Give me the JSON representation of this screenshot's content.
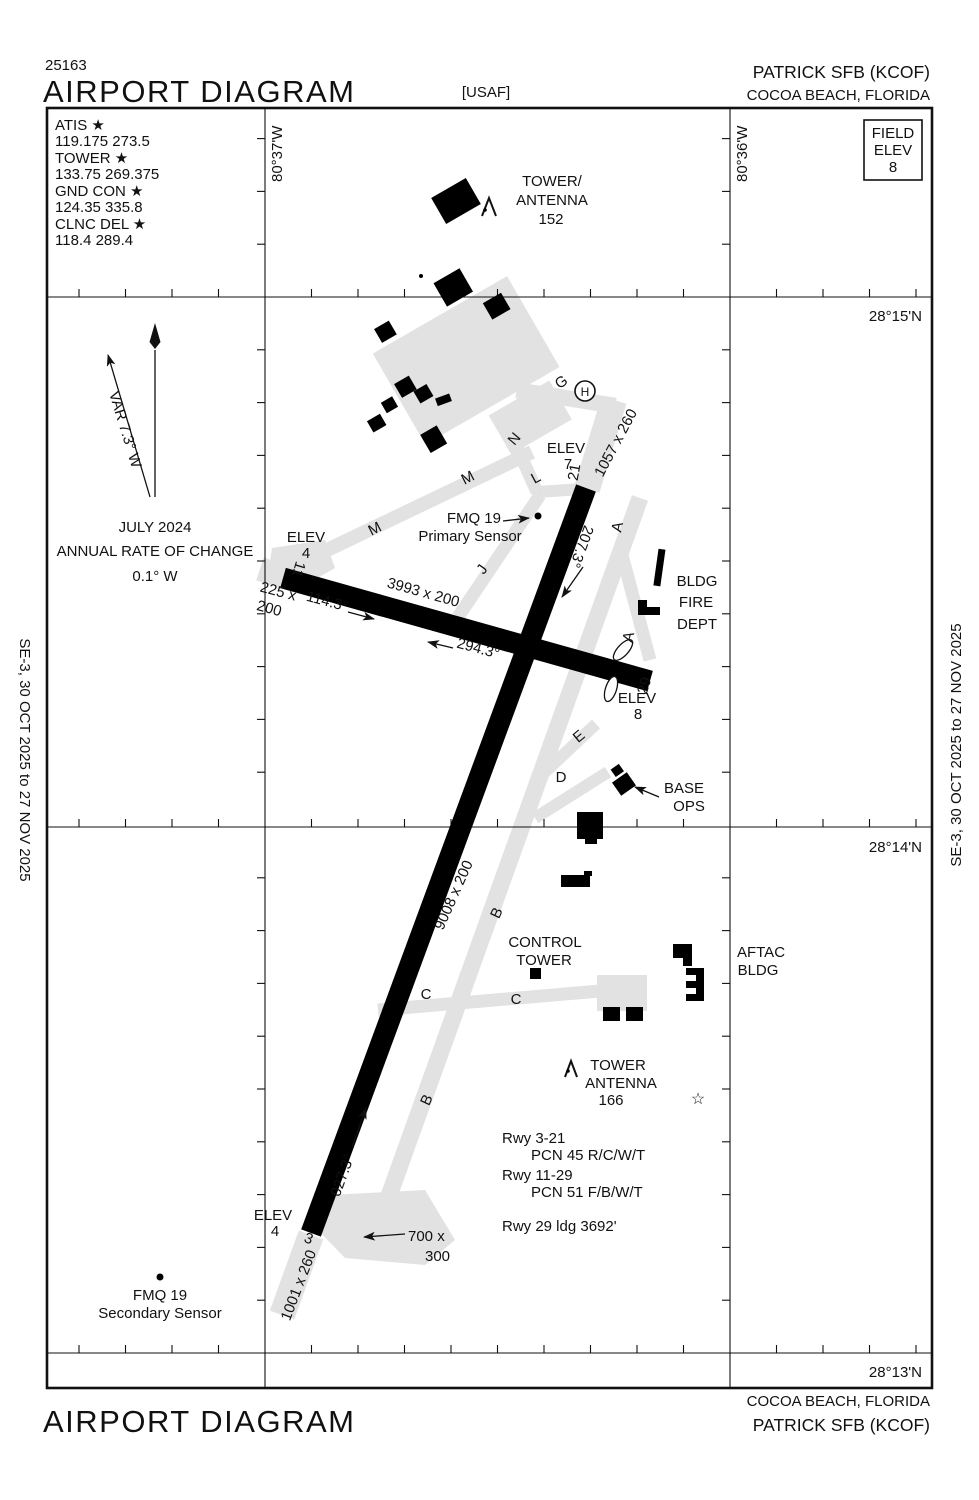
{
  "doc": {
    "chart_number": "25163",
    "title": "AIRPORT DIAGRAM",
    "title_bottom": "AIRPORT DIAGRAM",
    "operator": "[USAF]",
    "airport_top": "PATRICK SFB  (KCOF)",
    "city_top": "COCOA BEACH, FLORIDA",
    "airport_bottom": "PATRICK SFB  (KCOF)",
    "city_bottom": "COCOA BEACH, FLORIDA",
    "edition_left": "SE-3,  30 OCT 2025  to  27 NOV 2025",
    "edition_right": "SE-3,  30 OCT 2025  to  27 NOV 2025"
  },
  "comms": {
    "lines": [
      "ATIS ★",
      "119.175  273.5",
      "TOWER ★",
      "133.75  269.375",
      "GND CON ★",
      "124.35  335.8",
      "CLNC DEL ★",
      "118.4  289.4"
    ]
  },
  "field_elev": {
    "lines": [
      "FIELD",
      "ELEV",
      "8"
    ]
  },
  "graticule": {
    "lon": [
      "80°37'W",
      "80°36'W"
    ],
    "lat": [
      "28°15'N",
      "28°14'N",
      "28°13'N"
    ]
  },
  "variation": {
    "var_label": "VAR 7.3° W",
    "date": "JULY 2024",
    "caption": "ANNUAL RATE OF CHANGE",
    "rate": "0.1° W"
  },
  "runways": {
    "rwy_3_21": {
      "num_3": "3",
      "num_21": "21",
      "dim": "9008 x 200",
      "hdg_ne": "027.3°",
      "hdg_sw": "207.3°",
      "overrun_21": "1057 x 260",
      "overrun_3": "1001 x 260"
    },
    "rwy_11_29": {
      "num_11": "11",
      "num_29": "29",
      "dim": "3993 x 200",
      "hdg_se": "114.3°",
      "hdg_nw": "294.3°",
      "overrun_11_l1": "225 x",
      "overrun_11_l2": "200"
    },
    "pad_700_l1": "700 x",
    "pad_700_l2": "300"
  },
  "elevations": {
    "e7": [
      "ELEV",
      "7"
    ],
    "e4_mid": [
      "ELEV",
      "4"
    ],
    "e8": [
      "ELEV",
      "8"
    ],
    "e4_south": [
      "ELEV",
      "4"
    ]
  },
  "sensors": {
    "primary": [
      "FMQ 19",
      "Primary Sensor"
    ],
    "secondary": [
      "FMQ 19",
      "Secondary Sensor"
    ]
  },
  "facilities": {
    "tower152": [
      "TOWER/",
      "ANTENNA",
      "152"
    ],
    "fire": [
      "BLDG",
      "FIRE",
      "DEPT"
    ],
    "base_ops": [
      "BASE",
      "OPS"
    ],
    "control_tower": [
      "CONTROL",
      "TOWER"
    ],
    "aftac": [
      "AFTAC",
      "BLDG"
    ],
    "tower166": [
      "TOWER",
      "ANTENNA",
      "166"
    ],
    "helipad": "H",
    "star": "☆"
  },
  "taxiways": {
    "g": "G",
    "n": "N",
    "l": "L",
    "m1": "M",
    "m2": "M",
    "j": "J",
    "a1": "A",
    "a2": "A",
    "e": "E",
    "d": "D",
    "b1": "B",
    "b2": "B",
    "c1": "C",
    "c2": "C"
  },
  "notes": {
    "lines": [
      "Rwy 3-21",
      "PCN 45 R/C/W/T",
      "Rwy 11-29",
      "PCN 51 F/B/W/T"
    ],
    "ldg": "Rwy 29 ldg 3692'"
  },
  "colors": {
    "ink": "#111111",
    "taxiway_gray": "#e2e2e2"
  }
}
